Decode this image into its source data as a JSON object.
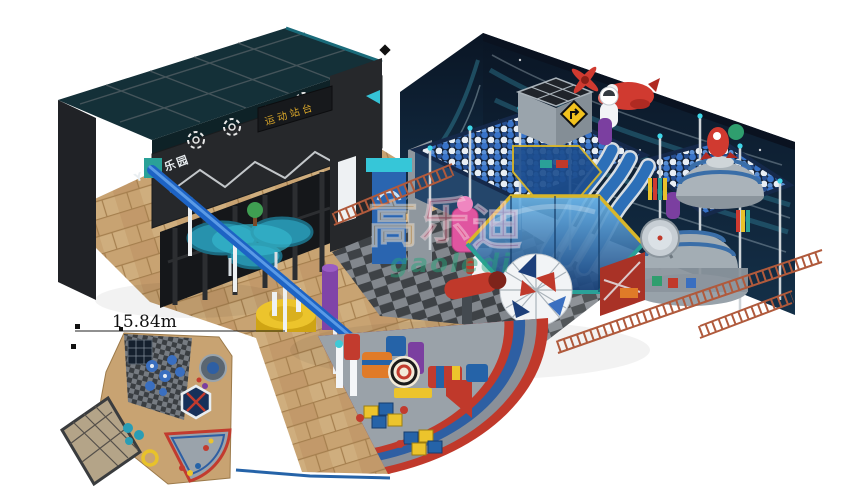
{
  "scene": {
    "type": "3d-render-indoor-playground-space-theme",
    "annotations": {
      "dimension": "15.84m"
    },
    "entrance": {
      "sign": "YIC 乐园",
      "banner": "运动站台"
    },
    "watermark": {
      "chars": [
        "高",
        "乐",
        "迪"
      ],
      "latin": "gaoledi"
    },
    "palette": {
      "wall_navy": "#0c1a2c",
      "entrance_charcoal": "#26282b",
      "floor_tan": "#c8a372",
      "accent_red": "#c0392b",
      "accent_blue": "#2563a8",
      "accent_cyan": "#3fc9d6",
      "accent_yellow": "#ecc42c",
      "fence_rust": "#b05a3c",
      "fan_floor_gray": "#9aa2a9",
      "glass_blue": "#1d4e8f"
    }
  }
}
